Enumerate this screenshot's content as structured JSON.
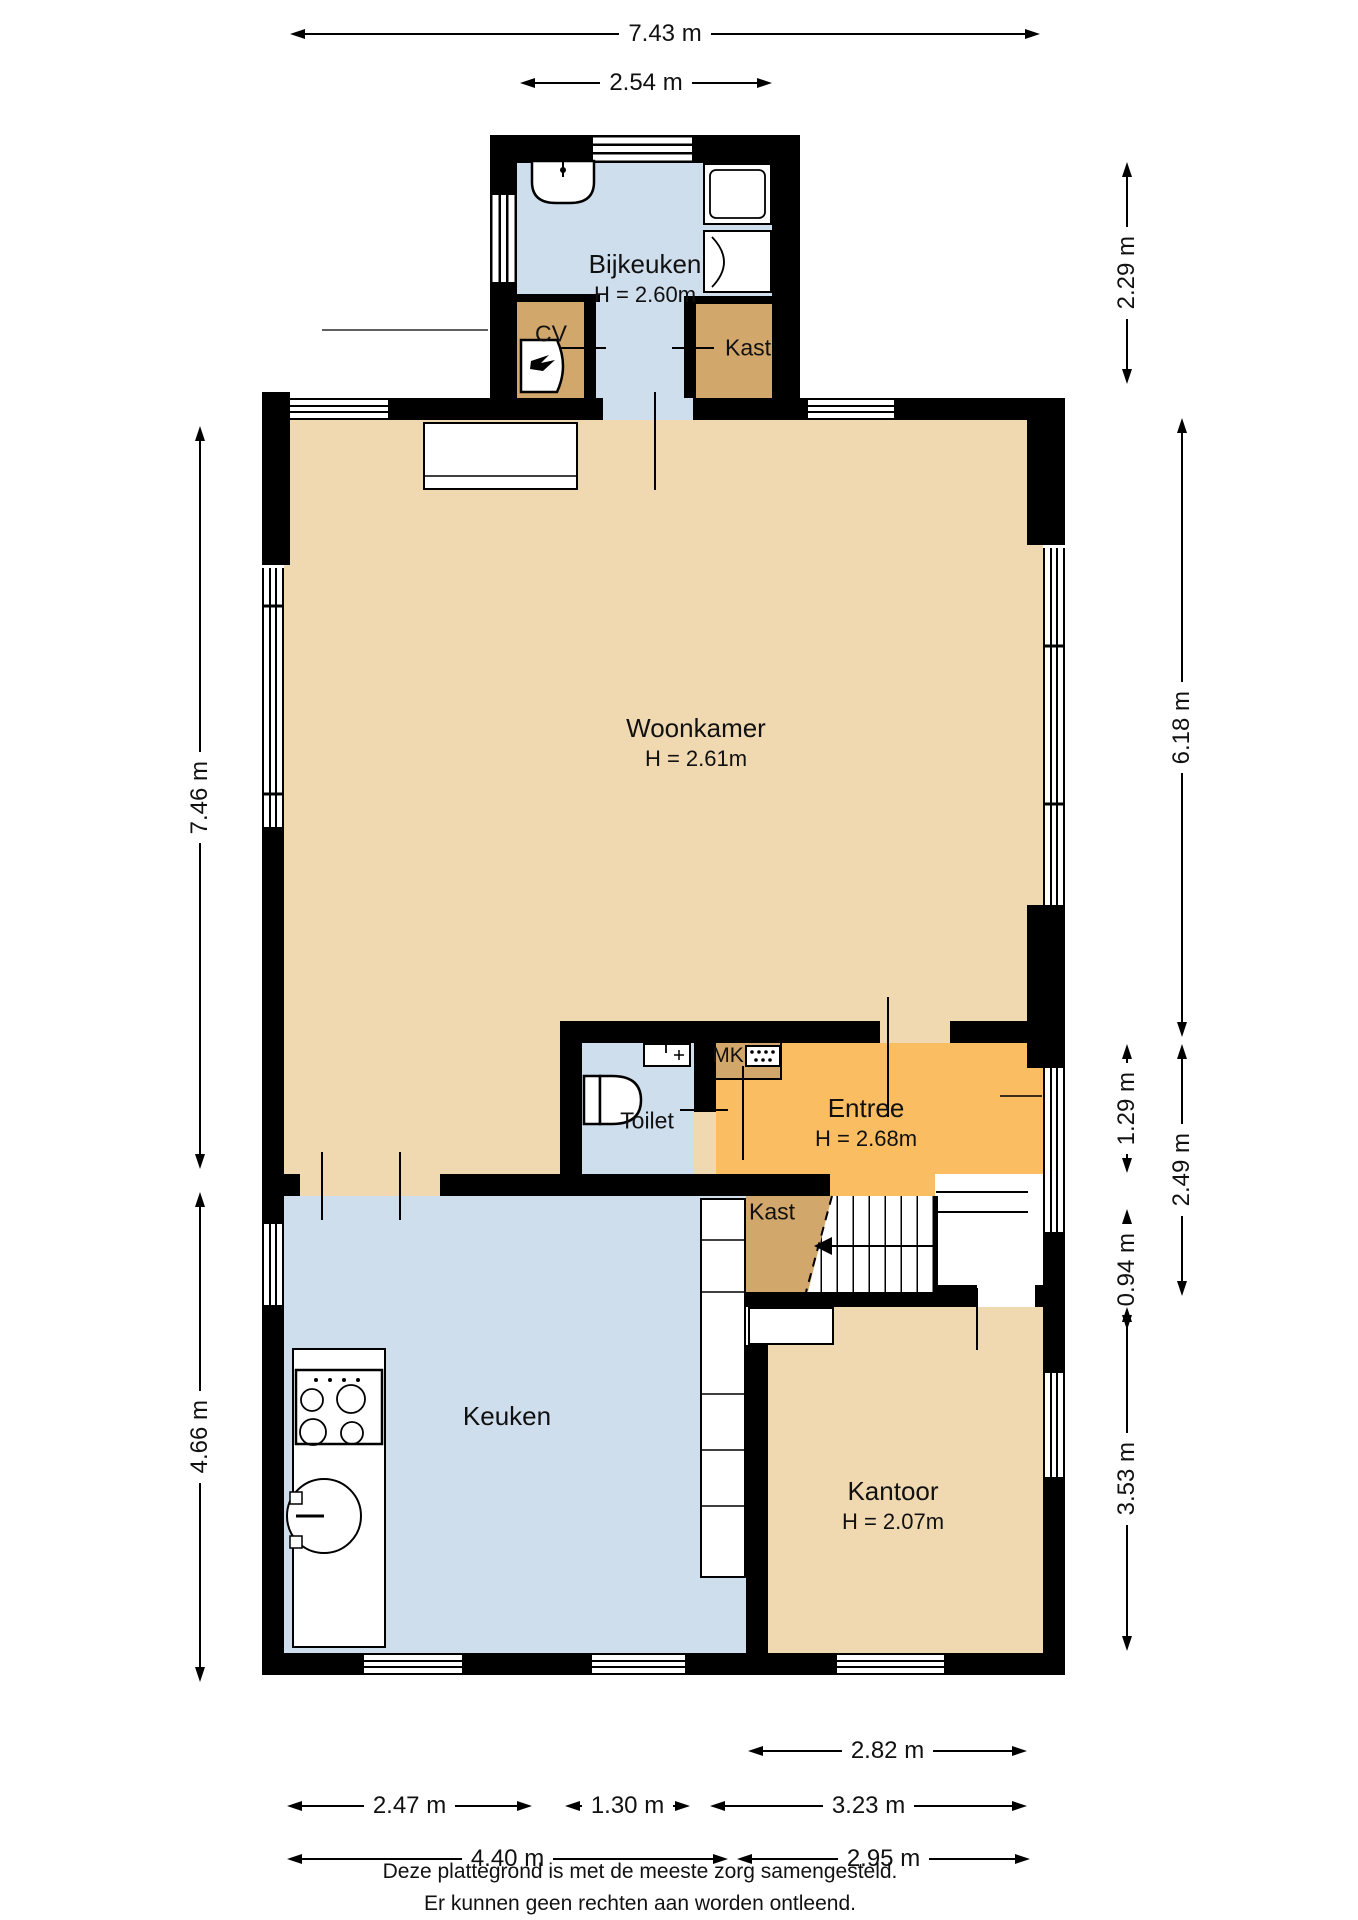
{
  "colors": {
    "wall": "#000000",
    "floor_tan": "#f0d9b1",
    "floor_orange": "#fabd61",
    "floor_brown": "#d2a76b",
    "floor_blue": "#cfdeed"
  },
  "rooms": {
    "bijkeuken": {
      "name": "Bijkeuken",
      "height": "H = 2.60m"
    },
    "cv": {
      "name": "CV"
    },
    "kast_top": {
      "name": "Kast"
    },
    "woonkamer": {
      "name": "Woonkamer",
      "height": "H = 2.61m"
    },
    "toilet": {
      "name": "Toilet"
    },
    "mk": {
      "name": "MK"
    },
    "entree": {
      "name": "Entree",
      "height": "H = 2.68m"
    },
    "kast_mid": {
      "name": "Kast"
    },
    "keuken": {
      "name": "Keuken"
    },
    "kantoor": {
      "name": "Kantoor",
      "height": "H = 2.07m"
    }
  },
  "dimensions": {
    "top_total": {
      "label": "7.43 m"
    },
    "top_bijkeuken": {
      "label": "2.54 m"
    },
    "left_upper": {
      "label": "7.46 m"
    },
    "left_lower": {
      "label": "4.66 m"
    },
    "right_bijkeuken": {
      "label": "2.29 m"
    },
    "right_woonkamer": {
      "label": "6.18 m"
    },
    "right_entree": {
      "label": "1.29 m"
    },
    "right_entree_total": {
      "label": "2.49 m"
    },
    "right_hal": {
      "label": "0.94 m"
    },
    "right_kantoor": {
      "label": "3.53 m"
    },
    "bottom_kantoor_top": {
      "label": "2.82 m"
    },
    "bottom_keuken_left": {
      "label": "2.47 m"
    },
    "bottom_keuken_mid": {
      "label": "1.30 m"
    },
    "bottom_kantoor_upper": {
      "label": "3.23 m"
    },
    "bottom_keuken_total": {
      "label": "4.40 m"
    },
    "bottom_kantoor_total": {
      "label": "2.95 m"
    }
  },
  "footer": {
    "line1": "Deze plattegrond is met de meeste zorg samengesteld.",
    "line2": "Er kunnen geen rechten aan worden ontleend."
  }
}
